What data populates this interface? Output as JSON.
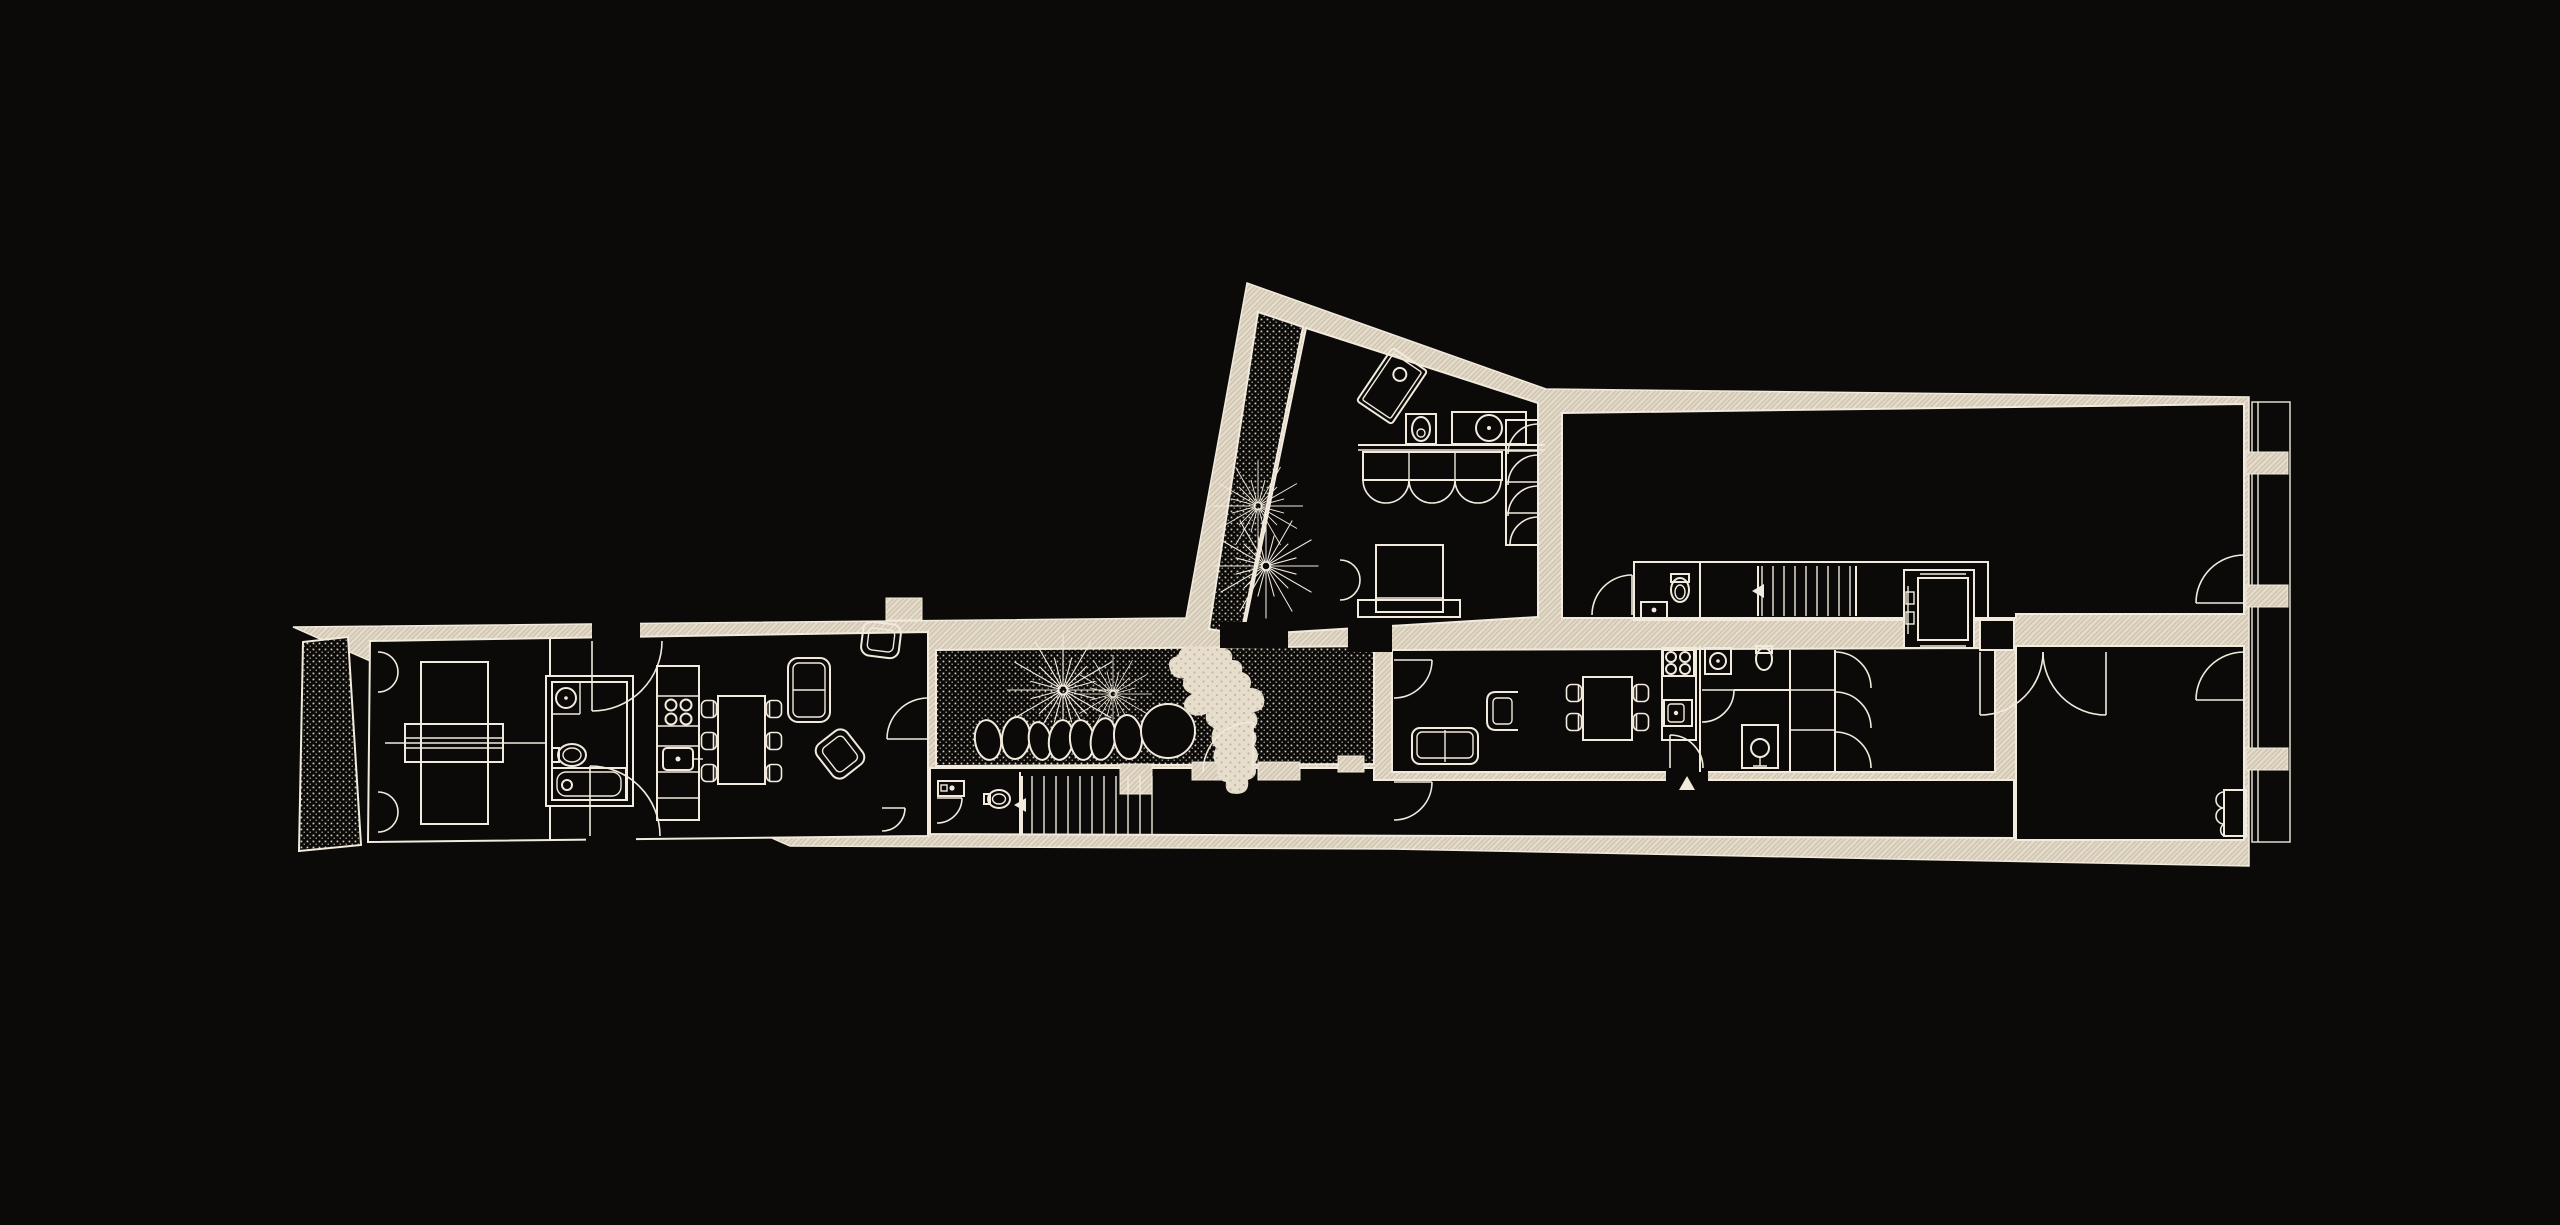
{
  "meta": {
    "title": "ground-floor-plan",
    "type": "architectural-floor-plan",
    "theme": "dark-linework"
  },
  "canvas": {
    "width": 2560,
    "height": 1225
  },
  "colors": {
    "background": "#0b0a08",
    "wall_fill": "#e6ddcc",
    "wall_hatch_line": "#cfc4b0",
    "line": "#f1eadd",
    "floor": "#0b0a08",
    "stipple_dot": "#d8cfbd",
    "paving_fill": "#e6ddcc",
    "paving_dot": "#c3b8a4"
  },
  "rooms": [
    {
      "name": "terrace",
      "finish": "stippled-paving"
    },
    {
      "name": "bedroom-west",
      "furniture": [
        "bed",
        "console"
      ]
    },
    {
      "name": "bathroom-west",
      "fixtures": [
        "sink",
        "toilet",
        "bathtub"
      ]
    },
    {
      "name": "kitchen-dining-west",
      "furniture": [
        "kitchen-island",
        "dining-table",
        "six-chairs"
      ]
    },
    {
      "name": "living-west",
      "furniture": [
        "sofa",
        "two-armchairs"
      ]
    },
    {
      "name": "garden-courtyard",
      "features": [
        "two-trees",
        "stone-row",
        "large-stone",
        "organic-path"
      ]
    },
    {
      "name": "wc-west",
      "fixtures": [
        "sink",
        "toilet"
      ]
    },
    {
      "name": "stair-west",
      "direction": "left"
    },
    {
      "name": "wing-atrium",
      "features": [
        "two-trees"
      ]
    },
    {
      "name": "wing-bedroom",
      "furniture": [
        "rotated-shower",
        "vanity-toilet-sink",
        "scalloped-wardrobe",
        "bed",
        "closet-column"
      ]
    },
    {
      "name": "grand-room",
      "furniture": []
    },
    {
      "name": "stair-hall",
      "fixtures": [
        "wc",
        "stair",
        "elevator"
      ]
    },
    {
      "name": "apartment-living",
      "furniture": [
        "sofa",
        "armchair",
        "dining-table",
        "four-chairs"
      ]
    },
    {
      "name": "apartment-kitchen",
      "fixtures": [
        "cooktop",
        "sink"
      ]
    },
    {
      "name": "apartment-bathroom",
      "fixtures": [
        "shower",
        "toilet",
        "pedestal-shower"
      ]
    },
    {
      "name": "apartment-wardrobe",
      "doors": 3
    },
    {
      "name": "east-room",
      "fixtures": [
        "double-door",
        "radiator"
      ]
    },
    {
      "name": "corridor-south",
      "length": "full-width"
    }
  ],
  "features": {
    "trees": 4,
    "stones": 8,
    "entrance_markers": 3,
    "elevator": 1,
    "staircases": 2,
    "window_strip_side": "east"
  }
}
